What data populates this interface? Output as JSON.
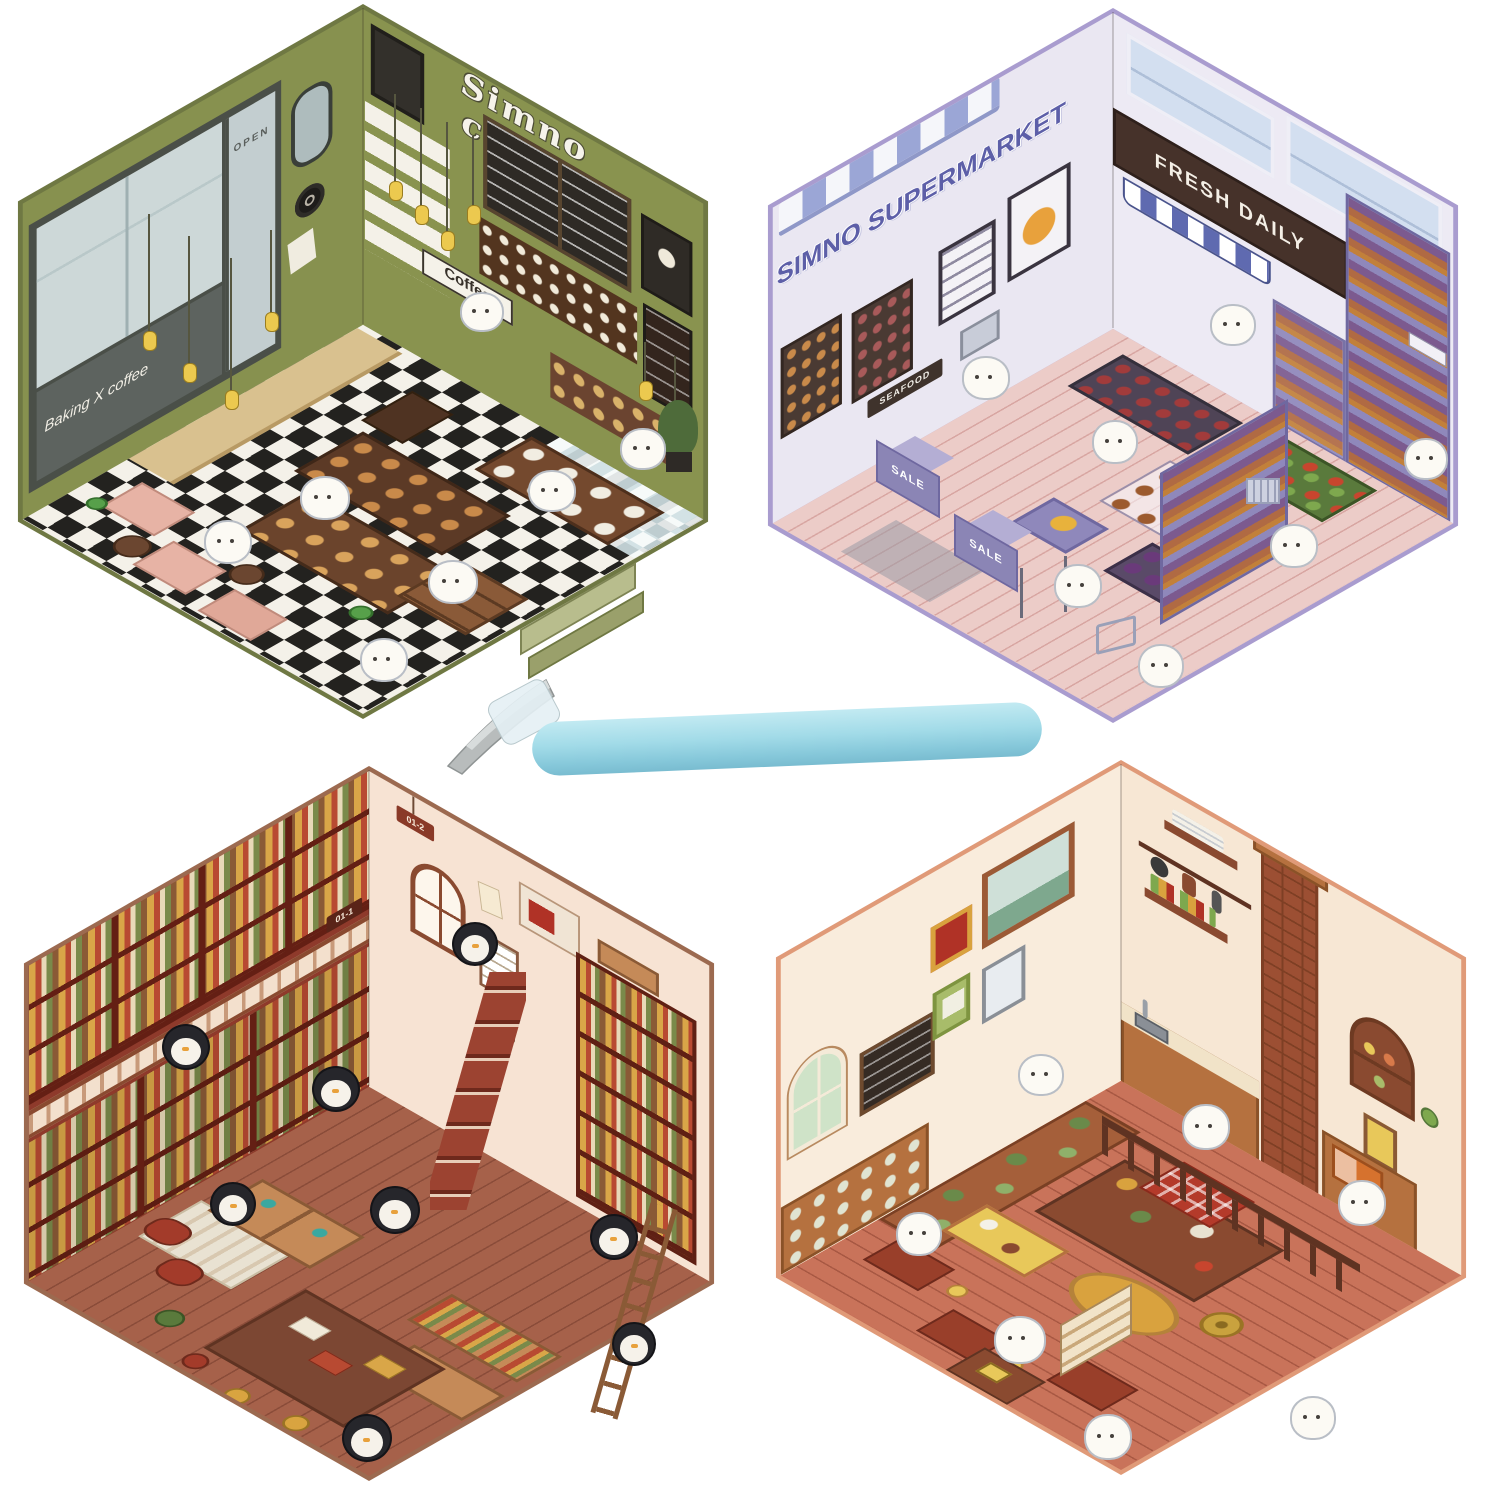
{
  "background_color": "#ffffff",
  "tool": {
    "icon": "tweezers-icon",
    "handle_color": "#a2dbe8",
    "tip_color": "#b8bcbc"
  },
  "scenes": {
    "coffee_shop": {
      "title": "Simno coffee",
      "counter_sign": "Coffee",
      "window_text": "Baking X coffee",
      "door_text": "OPEN",
      "colors": {
        "wall": "#87914f",
        "edge": "#6f7843",
        "floor_dark": "#23221f",
        "floor_light": "#f4f1e9",
        "sofa": "#e7b3a5",
        "counter_wood": "#5c3a26",
        "stand_tab": "#9aa06b",
        "lamp": "#ecc94f"
      }
    },
    "supermarket": {
      "title": "SIMNO SUPERMARKET",
      "awning_sign": "FRESH DAILY",
      "seafood_sign": "SEAFOOD",
      "checkout_sign": "SALE",
      "colors": {
        "wall": "#eae7f2",
        "edge": "#a99ccf",
        "title_text": "#5d5fa8",
        "fascia": "#46322a",
        "awning_blue": "#9ba6d6",
        "floor": "#ecccc8",
        "shelf": "#8f88bb"
      }
    },
    "library": {
      "shelf_tag_upper": "01-2",
      "shelf_tag_lower": "01-1",
      "colors": {
        "wall": "#f7e3d3",
        "edge": "#9c6a50",
        "shelf": "#8e3a2b",
        "floor": "#a6614a",
        "table": "#7c4733",
        "penguin": "#26262b"
      }
    },
    "kitchen": {
      "colors": {
        "wall": "#f9ecdc",
        "edge": "#e09a78",
        "brick": "#9c4f33",
        "floor": "#c9735a",
        "cabinet": "#b5713f",
        "rug": "#d9a23e"
      }
    }
  }
}
